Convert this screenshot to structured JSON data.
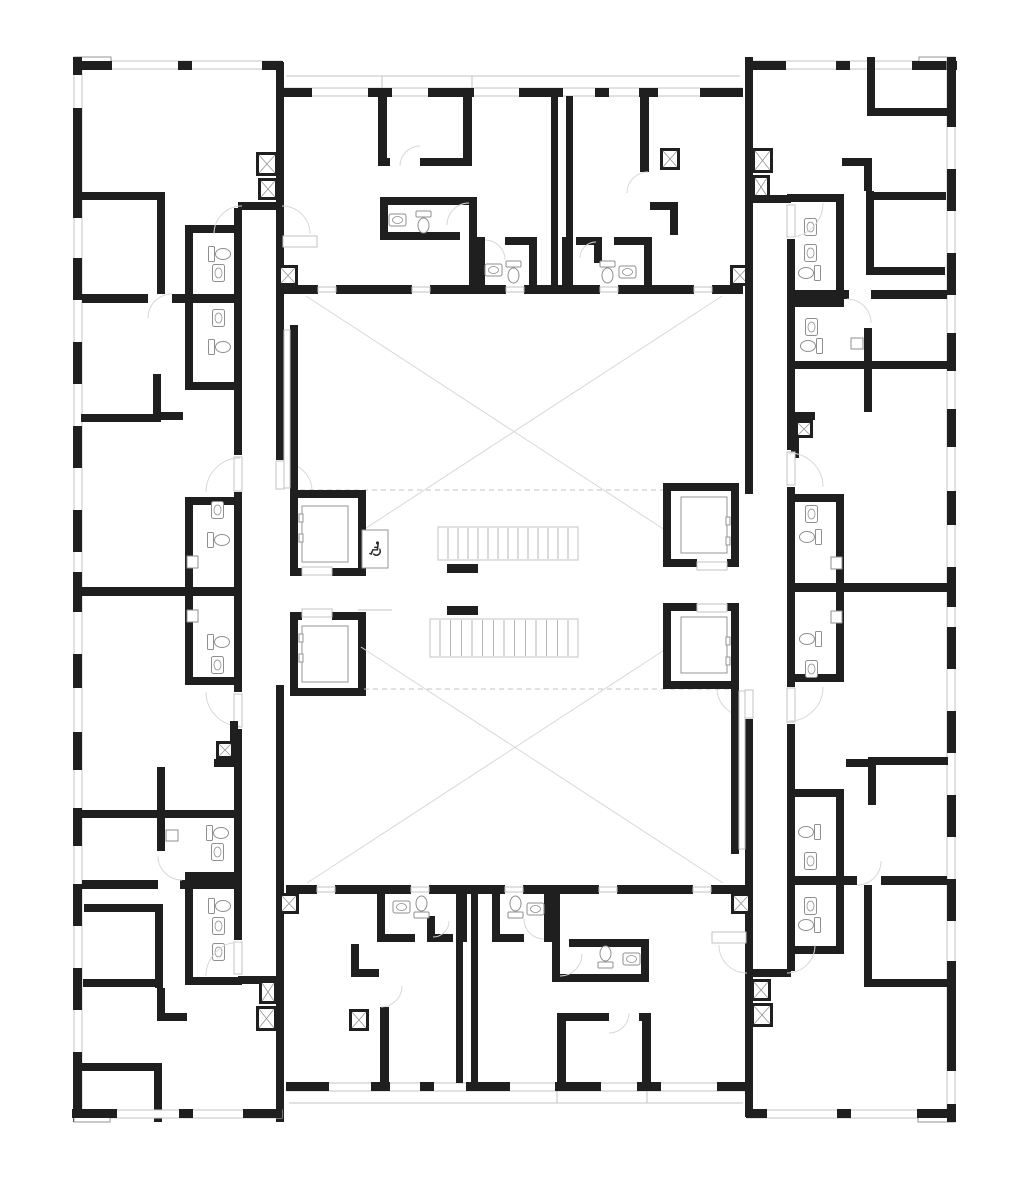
{
  "meta": {
    "drawing_type": "residential-floor-plan",
    "scale_units": "px"
  },
  "canvas": {
    "w": 1024,
    "h": 1184,
    "bg": "#ffffff"
  },
  "colors": {
    "wall": "#1f1f1f",
    "line": "#949494",
    "light": "#c3c3c3",
    "faint": "#d8d8d8",
    "fixture": "#8f8f8f"
  },
  "symmetry": {
    "cx": 514.5,
    "cy": 589.5
  },
  "icons": {
    "wheelchair": "♿"
  },
  "wheelchair_box": {
    "x": 362,
    "y": 530,
    "w": 26,
    "h": 38
  },
  "elements": [
    {
      "t": "wr",
      "x": 74,
      "y": 57,
      "w": 8,
      "h": 1065,
      "c": "light",
      "m": 1
    },
    {
      "t": "wr",
      "x": 74,
      "y": 61,
      "w": 208,
      "h": 8,
      "c": "light",
      "m": 1
    },
    {
      "t": "wr",
      "x": 283,
      "y": 88,
      "w": 459,
      "h": 8,
      "c": "light",
      "m": 1
    },
    {
      "t": "wr",
      "x": 747,
      "y": 61,
      "w": 208,
      "h": 8,
      "c": "light",
      "m": 1
    },
    {
      "t": "l",
      "x": 286,
      "y": 76,
      "x2": 740,
      "y2": 76,
      "c": "light",
      "m": 1
    },
    {
      "t": "l",
      "x": 382,
      "y": 76,
      "x2": 382,
      "y2": 88,
      "c": "light",
      "m": 1
    },
    {
      "t": "l",
      "x": 472,
      "y": 76,
      "x2": 472,
      "y2": 88,
      "c": "light",
      "m": 1
    },
    {
      "t": "wr",
      "x": 75,
      "y": 57,
      "w": 36,
      "h": 8,
      "c": "line",
      "m": 1
    },
    {
      "t": "wr",
      "x": 919,
      "y": 57,
      "w": 36,
      "h": 8,
      "c": "line",
      "m": 1
    },
    {
      "t": "r",
      "x": 73,
      "y": 57,
      "w": 9,
      "h": 18,
      "m": 1
    },
    {
      "t": "r",
      "x": 73,
      "y": 108,
      "w": 9,
      "h": 110,
      "m": 1
    },
    {
      "t": "r",
      "x": 73,
      "y": 258,
      "w": 9,
      "h": 42,
      "m": 1
    },
    {
      "t": "r",
      "x": 73,
      "y": 342,
      "w": 9,
      "h": 42,
      "m": 1
    },
    {
      "t": "r",
      "x": 73,
      "y": 426,
      "w": 9,
      "h": 42,
      "m": 1
    },
    {
      "t": "r",
      "x": 73,
      "y": 510,
      "w": 9,
      "h": 42,
      "m": 1
    },
    {
      "t": "r",
      "x": 73,
      "y": 572,
      "w": 9,
      "h": 40,
      "m": 1
    },
    {
      "t": "r",
      "x": 73,
      "y": 654,
      "w": 9,
      "h": 34,
      "m": 1
    },
    {
      "t": "r",
      "x": 73,
      "y": 732,
      "w": 9,
      "h": 38,
      "m": 1
    },
    {
      "t": "r",
      "x": 73,
      "y": 808,
      "w": 9,
      "h": 38,
      "m": 1
    },
    {
      "t": "r",
      "x": 73,
      "y": 884,
      "w": 9,
      "h": 42,
      "m": 1
    },
    {
      "t": "r",
      "x": 73,
      "y": 968,
      "w": 9,
      "h": 42,
      "m": 1
    },
    {
      "t": "r",
      "x": 73,
      "y": 1052,
      "w": 9,
      "h": 70,
      "m": 1
    },
    {
      "t": "r",
      "x": 73,
      "y": 61,
      "w": 39,
      "h": 9,
      "m": 1
    },
    {
      "t": "r",
      "x": 178,
      "y": 61,
      "w": 14,
      "h": 9,
      "m": 1
    },
    {
      "t": "r",
      "x": 262,
      "y": 61,
      "w": 21,
      "h": 9,
      "m": 1
    },
    {
      "t": "r",
      "x": 282,
      "y": 88,
      "w": 30,
      "h": 9,
      "m": 1
    },
    {
      "t": "r",
      "x": 368,
      "y": 88,
      "w": 24,
      "h": 9,
      "m": 1
    },
    {
      "t": "r",
      "x": 428,
      "y": 88,
      "w": 46,
      "h": 9,
      "m": 1
    },
    {
      "t": "r",
      "x": 519,
      "y": 88,
      "w": 44,
      "h": 9,
      "m": 1
    },
    {
      "t": "r",
      "x": 595,
      "y": 88,
      "w": 14,
      "h": 9,
      "m": 1
    },
    {
      "t": "r",
      "x": 639,
      "y": 88,
      "w": 19,
      "h": 9,
      "m": 1
    },
    {
      "t": "r",
      "x": 700,
      "y": 88,
      "w": 43,
      "h": 9,
      "m": 1
    },
    {
      "t": "r",
      "x": 747,
      "y": 61,
      "w": 39,
      "h": 9,
      "m": 1
    },
    {
      "t": "r",
      "x": 836,
      "y": 61,
      "w": 14,
      "h": 9,
      "m": 1
    },
    {
      "t": "r",
      "x": 912,
      "y": 61,
      "w": 45,
      "h": 9,
      "m": 1
    },
    {
      "t": "r",
      "x": 234,
      "y": 208,
      "w": 8,
      "h": 247,
      "m": 1
    },
    {
      "t": "r",
      "x": 234,
      "y": 492,
      "w": 8,
      "h": 200,
      "m": 1
    },
    {
      "t": "r",
      "x": 234,
      "y": 729,
      "w": 8,
      "h": 211,
      "m": 1
    },
    {
      "t": "r",
      "x": 238,
      "y": 202,
      "w": 46,
      "h": 8,
      "m": 1
    },
    {
      "t": "r",
      "x": 238,
      "y": 976,
      "w": 46,
      "h": 8,
      "m": 1
    },
    {
      "t": "r",
      "x": 276,
      "y": 62,
      "w": 8,
      "h": 398,
      "m": 1
    },
    {
      "t": "r",
      "x": 276,
      "y": 685,
      "w": 8,
      "h": 437,
      "m": 1
    },
    {
      "t": "wr",
      "x": 234,
      "y": 457,
      "w": 8,
      "h": 34,
      "c": "light",
      "m": 1
    },
    {
      "t": "wr",
      "x": 234,
      "y": 694,
      "w": 8,
      "h": 33,
      "c": "light",
      "m": 1
    },
    {
      "t": "wr",
      "x": 234,
      "y": 942,
      "w": 8,
      "h": 32,
      "c": "light",
      "m": 1
    },
    {
      "t": "wr",
      "x": 276,
      "y": 461,
      "w": 8,
      "h": 28,
      "c": "light",
      "m": 1
    },
    {
      "t": "r",
      "x": 82,
      "y": 294,
      "w": 66,
      "h": 9,
      "m": 1
    },
    {
      "t": "r",
      "x": 172,
      "y": 294,
      "w": 66,
      "h": 9,
      "m": 1
    },
    {
      "t": "r",
      "x": 82,
      "y": 587,
      "w": 156,
      "h": 9,
      "m": 1
    },
    {
      "t": "r",
      "x": 82,
      "y": 880,
      "w": 76,
      "h": 9,
      "m": 1
    },
    {
      "t": "r",
      "x": 180,
      "y": 880,
      "w": 58,
      "h": 9,
      "m": 1
    },
    {
      "t": "r",
      "x": 81,
      "y": 192,
      "w": 84,
      "h": 8,
      "m": 1
    },
    {
      "t": "r",
      "x": 157,
      "y": 192,
      "w": 8,
      "h": 102,
      "m": 1
    },
    {
      "t": "r",
      "x": 185,
      "y": 225,
      "w": 57,
      "h": 8,
      "m": 1
    },
    {
      "t": "r",
      "x": 185,
      "y": 225,
      "w": 8,
      "h": 69,
      "m": 1
    },
    {
      "t": "r",
      "x": 185,
      "y": 303,
      "w": 8,
      "h": 87,
      "m": 1
    },
    {
      "t": "r",
      "x": 185,
      "y": 382,
      "w": 57,
      "h": 8,
      "m": 1
    },
    {
      "t": "r",
      "x": 81,
      "y": 414,
      "w": 76,
      "h": 8,
      "m": 1
    },
    {
      "t": "r",
      "x": 153,
      "y": 374,
      "w": 8,
      "h": 48,
      "m": 1
    },
    {
      "t": "r",
      "x": 157,
      "y": 412,
      "w": 26,
      "h": 8,
      "m": 1
    },
    {
      "t": "r",
      "x": 185,
      "y": 497,
      "w": 57,
      "h": 8,
      "m": 1
    },
    {
      "t": "r",
      "x": 185,
      "y": 497,
      "w": 8,
      "h": 92,
      "m": 1
    },
    {
      "t": "r",
      "x": 185,
      "y": 596,
      "w": 8,
      "h": 89,
      "m": 1
    },
    {
      "t": "r",
      "x": 185,
      "y": 677,
      "w": 57,
      "h": 8,
      "m": 1
    },
    {
      "t": "r",
      "x": 157,
      "y": 767,
      "w": 8,
      "h": 84,
      "m": 1
    },
    {
      "t": "r",
      "x": 81,
      "y": 810,
      "w": 157,
      "h": 8,
      "m": 1
    },
    {
      "t": "r",
      "x": 185,
      "y": 872,
      "w": 57,
      "h": 8,
      "m": 1
    },
    {
      "t": "r",
      "x": 155,
      "y": 904,
      "w": 8,
      "h": 84,
      "m": 1
    },
    {
      "t": "r",
      "x": 84,
      "y": 904,
      "w": 74,
      "h": 8,
      "m": 1
    },
    {
      "t": "r",
      "x": 83,
      "y": 979,
      "w": 80,
      "h": 8,
      "m": 1
    },
    {
      "t": "r",
      "x": 185,
      "y": 888,
      "w": 8,
      "h": 97,
      "m": 1
    },
    {
      "t": "r",
      "x": 185,
      "y": 977,
      "w": 57,
      "h": 8,
      "m": 1
    },
    {
      "t": "r",
      "x": 157,
      "y": 988,
      "w": 8,
      "h": 33,
      "m": 1
    },
    {
      "t": "r",
      "x": 157,
      "y": 1013,
      "w": 30,
      "h": 8,
      "m": 1
    },
    {
      "t": "r",
      "x": 82,
      "y": 1063,
      "w": 80,
      "h": 8,
      "m": 1
    },
    {
      "t": "r",
      "x": 154,
      "y": 1063,
      "w": 8,
      "h": 59,
      "m": 1
    },
    {
      "t": "tl",
      "x": 212,
      "y": 243,
      "r": 270,
      "m": 1
    },
    {
      "t": "sk",
      "x": 210,
      "y": 267,
      "r": 270,
      "m": 1
    },
    {
      "t": "tl",
      "x": 212,
      "y": 336,
      "r": 270,
      "m": 1
    },
    {
      "t": "sk",
      "x": 210,
      "y": 312,
      "r": 270,
      "m": 1
    },
    {
      "t": "sk",
      "x": 209,
      "y": 504,
      "r": 270,
      "m": 1
    },
    {
      "t": "tl",
      "x": 211,
      "y": 529,
      "r": 270,
      "m": 1
    },
    {
      "t": "wr",
      "x": 187,
      "y": 556,
      "w": 11,
      "h": 12,
      "c": "fixture",
      "m": 1
    },
    {
      "t": "tl",
      "x": 211,
      "y": 631,
      "r": 270,
      "m": 1
    },
    {
      "t": "sk",
      "x": 209,
      "y": 659,
      "r": 270,
      "m": 1
    },
    {
      "t": "wr",
      "x": 187,
      "y": 610,
      "w": 11,
      "h": 12,
      "c": "fixture",
      "m": 1
    },
    {
      "t": "tl",
      "x": 210,
      "y": 822,
      "r": 270,
      "m": 1
    },
    {
      "t": "sk",
      "x": 209,
      "y": 846,
      "r": 270,
      "m": 1
    },
    {
      "t": "wr",
      "x": 166,
      "y": 830,
      "w": 12,
      "h": 11,
      "c": "fixture",
      "m": 1
    },
    {
      "t": "tl",
      "x": 212,
      "y": 895,
      "r": 270,
      "m": 1
    },
    {
      "t": "sk",
      "x": 210,
      "y": 920,
      "r": 270,
      "m": 1
    },
    {
      "t": "sk",
      "x": 210,
      "y": 946,
      "r": 270,
      "m": 1
    },
    {
      "t": "p",
      "d": "M214,234 A28,28 0 0 1 242,206",
      "m": 1
    },
    {
      "t": "p",
      "d": "M310,234 A28,28 0 0 0 282,206",
      "m": 1
    },
    {
      "t": "p",
      "d": "M240,458 A34,34 0 0 0 206,492",
      "m": 1
    },
    {
      "t": "p",
      "d": "M284,463 A28,28 0 0 1 312,491",
      "m": 1
    },
    {
      "t": "p",
      "d": "M206,692 A34,34 0 0 0 240,726",
      "m": 1
    },
    {
      "t": "p",
      "d": "M206,976 A34,34 0 0 1 240,942",
      "m": 1
    },
    {
      "t": "p",
      "d": "M148,318 A24,24 0 0 1 172,294",
      "m": 1
    },
    {
      "t": "p",
      "d": "M158,856 A24,24 0 0 0 182,880",
      "m": 1
    },
    {
      "t": "r",
      "x": 551,
      "y": 96,
      "w": 7,
      "h": 190,
      "m": 1
    },
    {
      "t": "r",
      "x": 566,
      "y": 96,
      "w": 7,
      "h": 190,
      "m": 1
    },
    {
      "t": "r",
      "x": 378,
      "y": 95,
      "w": 9,
      "h": 68,
      "m": 1
    },
    {
      "t": "r",
      "x": 378,
      "y": 158,
      "w": 12,
      "h": 8,
      "m": 1
    },
    {
      "t": "r",
      "x": 420,
      "y": 158,
      "w": 52,
      "h": 8,
      "m": 1
    },
    {
      "t": "r",
      "x": 463,
      "y": 95,
      "w": 9,
      "h": 71,
      "m": 1
    },
    {
      "t": "p",
      "d": "M400,166 A20,20 0 0 1 420,146",
      "m": 1
    },
    {
      "t": "r",
      "x": 380,
      "y": 197,
      "w": 97,
      "h": 8,
      "m": 1
    },
    {
      "t": "r",
      "x": 380,
      "y": 205,
      "w": 8,
      "h": 30,
      "m": 1
    },
    {
      "t": "r",
      "x": 380,
      "y": 232,
      "w": 80,
      "h": 8,
      "m": 1
    },
    {
      "t": "r",
      "x": 469,
      "y": 205,
      "w": 8,
      "h": 88,
      "m": 1
    },
    {
      "t": "p",
      "d": "M447,225 A22,22 0 0 1 469,203",
      "m": 1
    },
    {
      "t": "sk",
      "x": 389,
      "y": 214,
      "r": 0,
      "m": 1
    },
    {
      "t": "tl",
      "x": 416,
      "y": 211,
      "r": 0,
      "m": 1
    },
    {
      "t": "r",
      "x": 477,
      "y": 237,
      "w": 8,
      "h": 57,
      "m": 1
    },
    {
      "t": "r",
      "x": 505,
      "y": 237,
      "w": 32,
      "h": 8,
      "m": 1
    },
    {
      "t": "r",
      "x": 529,
      "y": 237,
      "w": 8,
      "h": 57,
      "m": 1
    },
    {
      "t": "p",
      "d": "M485,240 A20,20 0 0 1 505,260",
      "m": 1
    },
    {
      "t": "sk",
      "x": 485,
      "y": 264,
      "r": 0,
      "m": 1
    },
    {
      "t": "tl",
      "x": 506,
      "y": 261,
      "r": 0,
      "m": 1
    },
    {
      "t": "wr",
      "x": 283,
      "y": 236,
      "w": 34,
      "h": 11,
      "c": "light",
      "m": 1
    },
    {
      "t": "r",
      "x": 640,
      "y": 93,
      "w": 9,
      "h": 79,
      "m": 1
    },
    {
      "t": "p",
      "d": "M627,193 A21,21 0 0 1 648,172",
      "m": 1
    },
    {
      "t": "r",
      "x": 650,
      "y": 202,
      "w": 28,
      "h": 8,
      "m": 1
    },
    {
      "t": "r",
      "x": 670,
      "y": 202,
      "w": 8,
      "h": 33,
      "m": 1
    },
    {
      "t": "r",
      "x": 562,
      "y": 237,
      "w": 8,
      "h": 57,
      "m": 1
    },
    {
      "t": "r",
      "x": 576,
      "y": 237,
      "w": 20,
      "h": 8,
      "m": 1
    },
    {
      "t": "r",
      "x": 614,
      "y": 237,
      "w": 32,
      "h": 8,
      "m": 1
    },
    {
      "t": "r",
      "x": 594,
      "y": 237,
      "w": 8,
      "h": 26,
      "m": 1
    },
    {
      "t": "r",
      "x": 644,
      "y": 237,
      "w": 8,
      "h": 57,
      "m": 1
    },
    {
      "t": "tl",
      "x": 600,
      "y": 261,
      "r": 0,
      "m": 1
    },
    {
      "t": "sk",
      "x": 619,
      "y": 266,
      "r": 0,
      "m": 1
    },
    {
      "t": "p",
      "d": "M596,242 A16,16 0 0 0 580,258",
      "m": 1
    },
    {
      "t": "dt",
      "x": 660,
      "y": 148,
      "w": 20,
      "h": 22,
      "m": 1
    },
    {
      "t": "dt",
      "x": 256,
      "y": 152,
      "w": 22,
      "h": 24,
      "m": 1
    },
    {
      "t": "dt",
      "x": 258,
      "y": 178,
      "w": 20,
      "h": 22,
      "m": 1
    },
    {
      "t": "dt",
      "x": 752,
      "y": 148,
      "w": 21,
      "h": 25,
      "m": 1
    },
    {
      "t": "dt",
      "x": 752,
      "y": 175,
      "w": 18,
      "h": 24,
      "m": 1
    },
    {
      "t": "r",
      "x": 283,
      "y": 285,
      "w": 35,
      "h": 9,
      "m": 1
    },
    {
      "t": "r",
      "x": 336,
      "y": 285,
      "w": 76,
      "h": 9,
      "m": 1
    },
    {
      "t": "r",
      "x": 430,
      "y": 285,
      "w": 76,
      "h": 9,
      "m": 1
    },
    {
      "t": "r",
      "x": 524,
      "y": 285,
      "w": 76,
      "h": 9,
      "m": 1
    },
    {
      "t": "r",
      "x": 618,
      "y": 285,
      "w": 76,
      "h": 9,
      "m": 1
    },
    {
      "t": "r",
      "x": 712,
      "y": 285,
      "w": 31,
      "h": 9,
      "m": 1
    },
    {
      "t": "wr",
      "x": 318,
      "y": 287,
      "w": 18,
      "h": 5,
      "c": "light",
      "m": 1
    },
    {
      "t": "wr",
      "x": 412,
      "y": 287,
      "w": 18,
      "h": 5,
      "c": "light",
      "m": 1
    },
    {
      "t": "wr",
      "x": 506,
      "y": 287,
      "w": 18,
      "h": 5,
      "c": "light",
      "m": 1
    },
    {
      "t": "wr",
      "x": 600,
      "y": 287,
      "w": 18,
      "h": 5,
      "c": "light",
      "m": 1
    },
    {
      "t": "wr",
      "x": 694,
      "y": 287,
      "w": 18,
      "h": 5,
      "c": "light",
      "m": 1
    },
    {
      "t": "dt",
      "x": 278,
      "y": 265,
      "w": 20,
      "h": 21,
      "m": 1
    },
    {
      "t": "dt",
      "x": 730,
      "y": 265,
      "w": 20,
      "h": 21,
      "m": 1
    },
    {
      "t": "p",
      "d": "M306,296 L668,532",
      "c": "faint",
      "m": 1
    },
    {
      "t": "p",
      "d": "M722,296 L360,532",
      "c": "faint",
      "m": 1
    },
    {
      "t": "dl",
      "x": 300,
      "y": 490,
      "x2": 667,
      "y2": 490,
      "m": 1
    },
    {
      "t": "r",
      "x": 290,
      "y": 325,
      "w": 8,
      "h": 165,
      "m": 1
    },
    {
      "t": "wr",
      "x": 284,
      "y": 330,
      "w": 6,
      "h": 158,
      "c": "light",
      "m": 1
    },
    {
      "t": "r",
      "x": 791,
      "y": 412,
      "w": 8,
      "h": 46,
      "m": 1
    },
    {
      "t": "r",
      "x": 791,
      "y": 412,
      "w": 24,
      "h": 8,
      "m": 1
    },
    {
      "t": "dt",
      "x": 795,
      "y": 420,
      "w": 18,
      "h": 18,
      "m": 1
    },
    {
      "t": "r",
      "x": 290,
      "y": 490,
      "w": 76,
      "h": 8,
      "m": 1
    },
    {
      "t": "r",
      "x": 290,
      "y": 490,
      "w": 8,
      "h": 86,
      "m": 1
    },
    {
      "t": "r",
      "x": 358,
      "y": 490,
      "w": 8,
      "h": 86,
      "m": 1
    },
    {
      "t": "r",
      "x": 290,
      "y": 568,
      "w": 12,
      "h": 8,
      "m": 1
    },
    {
      "t": "r",
      "x": 332,
      "y": 568,
      "w": 34,
      "h": 8,
      "m": 1
    },
    {
      "t": "wr",
      "x": 302,
      "y": 567,
      "w": 30,
      "h": 8,
      "c": "light",
      "m": 1
    },
    {
      "t": "wr",
      "x": 302,
      "y": 506,
      "w": 46,
      "h": 56,
      "c": "line",
      "m": 1
    },
    {
      "t": "wr",
      "x": 299,
      "y": 514,
      "w": 4,
      "h": 8,
      "c": "line",
      "m": 1
    },
    {
      "t": "wr",
      "x": 299,
      "y": 534,
      "w": 4,
      "h": 8,
      "c": "line",
      "m": 1
    },
    {
      "t": "r",
      "x": 290,
      "y": 612,
      "w": 12,
      "h": 8,
      "m": 1
    },
    {
      "t": "r",
      "x": 332,
      "y": 612,
      "w": 34,
      "h": 8,
      "m": 1
    },
    {
      "t": "wr",
      "x": 302,
      "y": 609,
      "w": 30,
      "h": 8,
      "c": "light",
      "m": 1
    },
    {
      "t": "r",
      "x": 290,
      "y": 612,
      "w": 8,
      "h": 84,
      "m": 1
    },
    {
      "t": "r",
      "x": 358,
      "y": 612,
      "w": 8,
      "h": 84,
      "m": 1
    },
    {
      "t": "r",
      "x": 290,
      "y": 688,
      "w": 76,
      "h": 8,
      "m": 1
    },
    {
      "t": "wr",
      "x": 302,
      "y": 626,
      "w": 46,
      "h": 56,
      "c": "line",
      "m": 1
    },
    {
      "t": "wr",
      "x": 299,
      "y": 634,
      "w": 4,
      "h": 8,
      "c": "line",
      "m": 1
    },
    {
      "t": "wr",
      "x": 299,
      "y": 654,
      "w": 4,
      "h": 8,
      "c": "line",
      "m": 1
    },
    {
      "t": "wr",
      "x": 362,
      "y": 530,
      "w": 26,
      "h": 38,
      "c": "line"
    },
    {
      "t": "wr",
      "x": 438,
      "y": 527,
      "w": 140,
      "h": 33,
      "c": "light"
    },
    {
      "t": "td",
      "x": 448,
      "y": 528,
      "w": 120,
      "h": 31,
      "n": 12
    },
    {
      "t": "l",
      "x": 438,
      "y": 560,
      "x2": 578,
      "y2": 560,
      "c": "light"
    },
    {
      "t": "r",
      "x": 447,
      "y": 564,
      "w": 31,
      "h": 9
    },
    {
      "t": "wr",
      "x": 430,
      "y": 619,
      "w": 148,
      "h": 38,
      "c": "light"
    },
    {
      "t": "td",
      "x": 440,
      "y": 620,
      "w": 128,
      "h": 36,
      "n": 12
    },
    {
      "t": "r",
      "x": 447,
      "y": 606,
      "w": 31,
      "h": 9
    },
    {
      "t": "l",
      "x": 358,
      "y": 610,
      "x2": 392,
      "y2": 610,
      "c": "light"
    }
  ]
}
